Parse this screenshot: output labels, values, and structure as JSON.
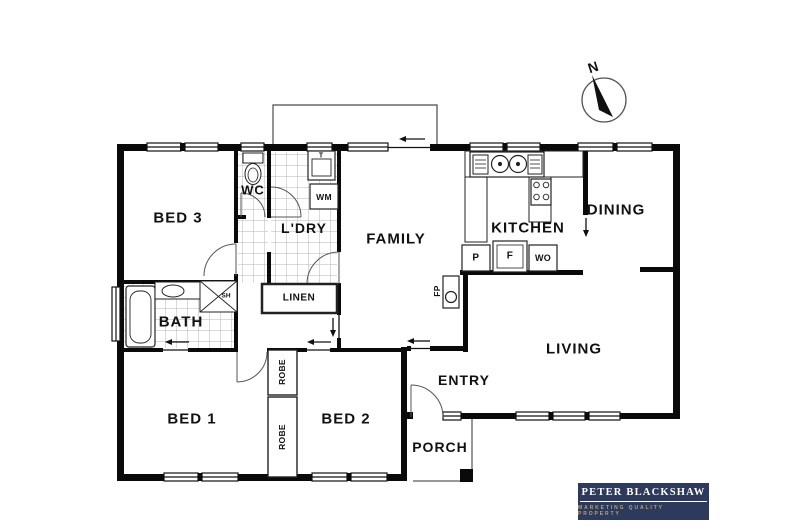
{
  "rooms": {
    "bed1": "BED 1",
    "bed2": "BED 2",
    "bed3": "BED 3",
    "bath": "BATH",
    "wc": "WC",
    "laundry": "L'DRY",
    "family": "FAMILY",
    "kitchen": "KITCHEN",
    "dining": "DINING",
    "living": "LIVING",
    "entry": "ENTRY",
    "porch": "PORCH"
  },
  "fixtures": {
    "linen": "LINEN",
    "robe_top": "ROBE",
    "robe_bottom": "ROBE",
    "washing_machine": "WM",
    "laundry_tub": "T",
    "pantry": "P",
    "fridge": "F",
    "wall_oven": "WO",
    "shower": "SH",
    "fireplace": "FP"
  },
  "compass": {
    "north": "N"
  },
  "branding": {
    "agency_name": "PETER BLACKSHAW",
    "tagline": "MARKETING QUALITY PROPERTY",
    "brand_color": "#2d3a5c",
    "tagline_color": "#b3a37e"
  },
  "colors": {
    "wall": "#0a0a0a",
    "tile_line": "#b5b5b5",
    "background": "#ffffff"
  }
}
